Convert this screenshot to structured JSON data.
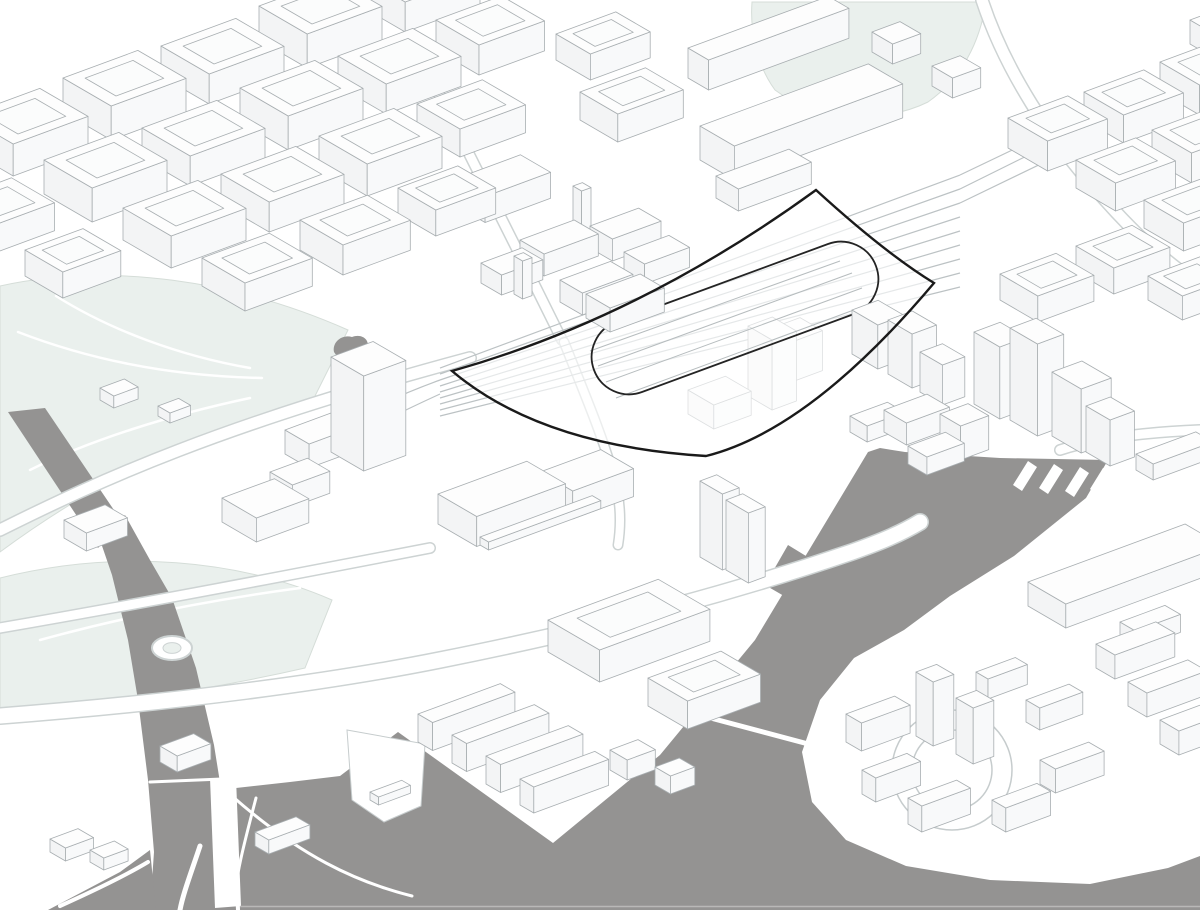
{
  "palette": {
    "bg": "#ffffff",
    "water": "#949392",
    "park": "#eaf0ed",
    "park_stroke": "#d5ddd8",
    "line": "#a8aeb1",
    "line_soft": "#c6cccd",
    "road_stroke": "#cdd3d3",
    "rail": "#bcc2c4",
    "rail_faint": "#b6bcbe",
    "face_top": "#fdfdfd",
    "face_left": "#f3f4f5",
    "face_right": "#f8f9fa",
    "court_fill": "#fbfcfc",
    "site_stroke": "#1a1a1a",
    "site_loop_stroke": "#242424",
    "site_fill": "#ffffff",
    "site_fill_opacity": 0.62,
    "waterline": "#b9b8b7"
  },
  "scene": {
    "width": 1200,
    "height": 910,
    "iso": {
      "u": [
        0.935,
        -0.345
      ],
      "v": [
        0.86,
        0.5
      ]
    },
    "parks": [
      "M0,286 C110,262 235,280 348,330 L312,402 C210,426 100,478 0,552 Z",
      "M0,578 C120,548 240,560 332,600 L305,668 C200,692 95,706 0,716 Z",
      "M752,2 L986,2 C980,42 962,78 928,102 C880,126 812,118 775,90 C756,64 750,30 752,2 Z"
    ],
    "park_paths": [
      "M18,332 C80,356 160,376 262,378",
      "M56,296 C110,330 180,356 250,368",
      "M30,470 C90,440 170,415 250,398",
      "M40,640 C120,618 210,600 300,588"
    ],
    "pond": "M334,352 C332,342 342,334 352,337 C362,333 371,340 367,350 C362,362 340,363 334,352 Z",
    "water": [
      "M8,412 L45,408 L122,522 L98,548 Z",
      "M100,540 L125,515 L150,560 L172,598 L196,668 L214,745 L226,820 L234,870 L236,910 L150,910 L154,852 L148,780 L138,700 L128,640 L112,575 Z",
      "M48,910 L120,872 L150,850 L156,910 Z",
      "M553,843 L660,755 L755,640 L868,452 L880,448 L905,452 L1000,458 L1108,460 L1086,498 L1014,556 L950,596 L904,630 L854,658 L820,700 L802,752 L812,802 L846,840 L906,866 L990,880 L1090,884 L1168,868 L1200,856 L1200,910 L240,910 L236,788 L290,782 L340,776 L398,732 Z",
      "M765,585 L788,545 L806,556 L784,596 Z",
      "M792,600 L820,552 L842,564 L816,612 Z"
    ],
    "quay_strokes": [
      [
        "M232,796 C300,856 356,882 412,896",
        3
      ],
      [
        "M256,798 C244,844 236,874 234,904",
        3
      ],
      [
        "M150,782 L222,779",
        3
      ],
      [
        "M200,846 C190,876 183,894 180,910",
        5
      ],
      [
        "M60,906 C100,888 128,874 148,862",
        4
      ],
      [
        "M688,712 L812,745",
        5
      ]
    ],
    "white_polys": [
      "M210,778 L236,778 L241,906 L215,908 Z",
      "M347,730 L425,744 L421,806 L384,822 L352,800 Z",
      "M1028,461 l-15,24 l9,6 l15,-24 Z",
      "M1054,464 l-15,24 l9,6 l15,-24 Z",
      "M1080,467 l-15,24 l9,6 l15,-24 Z",
      "M1103,468 l-13,21 l8,6 l14,-22 Z"
    ],
    "waterline": [
      240,
      906.5,
      1200,
      906.5
    ],
    "roads": [
      [
        "M0,716 C180,702 330,682 440,660 C620,624 740,590 852,552 C880,542 900,534 920,522",
        15,
        1
      ],
      [
        "M0,530 C100,480 220,425 470,358",
        11,
        1
      ],
      [
        "M436,88 C475,165 520,255 562,340",
        9,
        1
      ],
      [
        "M982,0 C1005,70 1050,140 1105,200 C1145,245 1175,268 1200,285",
        11,
        1
      ],
      [
        "M0,628 C150,602 290,575 430,548",
        9,
        1
      ],
      [
        "M564,342 C585,395 600,430 612,470 C620,495 622,520 618,545",
        8,
        1
      ],
      [
        "M1060,450 C1100,437 1150,432 1200,430",
        9,
        1
      ]
    ],
    "roundabout": {
      "cx": 172,
      "cy": 648,
      "rx": 20,
      "ry": 12
    },
    "ground_circles": [
      {
        "cx": 952,
        "cy": 770,
        "r": 60
      },
      {
        "cx": 952,
        "cy": 770,
        "r": 40
      }
    ],
    "rail_main": [
      [
        440,
        368,
        960,
        175
      ],
      [
        440,
        374,
        960,
        189
      ],
      [
        440,
        380,
        960,
        203
      ],
      [
        440,
        386,
        960,
        217
      ],
      [
        440,
        392,
        960,
        231
      ],
      [
        440,
        398,
        960,
        245
      ],
      [
        440,
        404,
        960,
        259
      ],
      [
        440,
        410,
        960,
        273
      ],
      [
        440,
        416,
        960,
        287
      ],
      [
        960,
        175,
        1075,
        120
      ],
      [
        960,
        189,
        1075,
        132
      ],
      [
        960,
        203,
        1078,
        146
      ]
    ],
    "rail_sidings": [
      "M440,380 C380,402 330,428 298,450",
      "M440,394 C392,416 348,438 318,458"
    ],
    "inner_tracks": [
      [
        598,
        366,
        852,
        273
      ],
      [
        606,
        382,
        862,
        288
      ],
      [
        616,
        398,
        870,
        304
      ],
      [
        590,
        351,
        840,
        261
      ]
    ],
    "site": {
      "outer": "M452,371 Q640,318 816,190 Q885,253 934,283 Q810,430 706,456 Q541,446 452,371 Z",
      "loop": "M642,392 L854,314 A37,37 0 0 0 828,244 L616,322 A37,37 0 0 0 642,392 Z"
    },
    "buildings_faded": [
      [
        688,
        414,
        40,
        30,
        24
      ],
      [
        748,
        396,
        26,
        28,
        70
      ],
      [
        772,
        368,
        30,
        26,
        40
      ]
    ],
    "buildings": [
      [
        -35,
        148,
        80,
        56,
        32,
        "c"
      ],
      [
        63,
        112,
        80,
        56,
        34,
        "c"
      ],
      [
        161,
        76,
        80,
        56,
        30,
        "c"
      ],
      [
        259,
        40,
        80,
        56,
        34,
        "c"
      ],
      [
        357,
        4,
        80,
        56,
        30,
        "c"
      ],
      [
        -54,
        230,
        70,
        50,
        28,
        "c"
      ],
      [
        44,
        194,
        80,
        56,
        34,
        "c"
      ],
      [
        142,
        158,
        80,
        56,
        30,
        "c"
      ],
      [
        240,
        122,
        80,
        56,
        34,
        "c"
      ],
      [
        338,
        86,
        80,
        56,
        30,
        "c"
      ],
      [
        436,
        50,
        70,
        50,
        30,
        "c"
      ],
      [
        25,
        276,
        62,
        44,
        26,
        "c"
      ],
      [
        123,
        240,
        80,
        56,
        32,
        "c"
      ],
      [
        221,
        204,
        80,
        56,
        30,
        "c"
      ],
      [
        319,
        168,
        80,
        56,
        32,
        "c"
      ],
      [
        417,
        132,
        70,
        50,
        28,
        "c"
      ],
      [
        202,
        286,
        72,
        50,
        28,
        "c"
      ],
      [
        300,
        250,
        72,
        50,
        30,
        "c"
      ],
      [
        398,
        214,
        64,
        44,
        26,
        "c"
      ],
      [
        455,
        205,
        70,
        35,
        26
      ],
      [
        520,
        262,
        58,
        28,
        22
      ],
      [
        481,
        283,
        44,
        24,
        20
      ],
      [
        560,
        302,
        54,
        26,
        22
      ],
      [
        586,
        318,
        58,
        28,
        24
      ],
      [
        573,
        228,
        10,
        10,
        42
      ],
      [
        514,
        294,
        10,
        10,
        38
      ],
      [
        590,
        248,
        52,
        26,
        22
      ],
      [
        624,
        272,
        48,
        24,
        20
      ],
      [
        688,
        78,
        150,
        24,
        30
      ],
      [
        700,
        160,
        180,
        40,
        34
      ],
      [
        716,
        198,
        78,
        26,
        22
      ],
      [
        872,
        52,
        30,
        24,
        20
      ],
      [
        932,
        86,
        30,
        24,
        20
      ],
      [
        580,
        120,
        70,
        44,
        28,
        "c"
      ],
      [
        556,
        60,
        64,
        40,
        26,
        "c"
      ],
      [
        1008,
        148,
        64,
        46,
        30,
        "c"
      ],
      [
        1084,
        120,
        64,
        46,
        28,
        "c"
      ],
      [
        1160,
        92,
        64,
        46,
        30,
        "c"
      ],
      [
        1076,
        188,
        64,
        46,
        28,
        "c"
      ],
      [
        1152,
        160,
        64,
        46,
        30,
        "c"
      ],
      [
        1144,
        228,
        64,
        46,
        28,
        "c"
      ],
      [
        1190,
        44,
        56,
        40,
        24,
        "c"
      ],
      [
        1000,
        300,
        60,
        44,
        26,
        "c"
      ],
      [
        1076,
        272,
        60,
        44,
        26,
        "c"
      ],
      [
        1148,
        300,
        56,
        40,
        24,
        "c"
      ],
      [
        884,
        432,
        46,
        26,
        22
      ],
      [
        908,
        464,
        40,
        22,
        18
      ],
      [
        940,
        448,
        30,
        24,
        34
      ],
      [
        974,
        404,
        28,
        30,
        72
      ],
      [
        1010,
        420,
        28,
        32,
        92
      ],
      [
        1052,
        436,
        32,
        34,
        64
      ],
      [
        1086,
        452,
        26,
        28,
        46
      ],
      [
        1028,
        606,
        168,
        44,
        24
      ],
      [
        1136,
        470,
        64,
        20,
        16
      ],
      [
        1120,
        640,
        48,
        18,
        18
      ],
      [
        1096,
        668,
        64,
        22,
        24
      ],
      [
        1128,
        706,
        64,
        22,
        24
      ],
      [
        1160,
        744,
        64,
        22,
        24
      ],
      [
        846,
        742,
        52,
        18,
        28
      ],
      [
        862,
        794,
        48,
        16,
        24
      ],
      [
        908,
        824,
        52,
        16,
        26
      ],
      [
        992,
        824,
        48,
        16,
        24
      ],
      [
        1040,
        784,
        52,
        18,
        24
      ],
      [
        1026,
        722,
        46,
        16,
        22
      ],
      [
        976,
        692,
        42,
        14,
        20
      ],
      [
        916,
        736,
        22,
        20,
        64
      ],
      [
        956,
        754,
        22,
        20,
        56
      ],
      [
        331,
        452,
        45,
        38,
        95
      ],
      [
        222,
        522,
        56,
        40,
        24
      ],
      [
        270,
        494,
        40,
        26,
        22
      ],
      [
        285,
        454,
        55,
        28,
        24
      ],
      [
        438,
        524,
        95,
        45,
        30
      ],
      [
        540,
        500,
        65,
        38,
        28
      ],
      [
        480,
        545,
        120,
        10,
        8
      ],
      [
        700,
        557,
        18,
        26,
        76
      ],
      [
        726,
        570,
        18,
        26,
        70
      ],
      [
        852,
        354,
        28,
        30,
        44
      ],
      [
        888,
        374,
        26,
        28,
        54
      ],
      [
        920,
        392,
        24,
        26,
        40
      ],
      [
        850,
        432,
        40,
        20,
        16
      ],
      [
        64,
        538,
        44,
        26,
        18
      ],
      [
        548,
        652,
        118,
        60,
        32,
        "c"
      ],
      [
        648,
        706,
        78,
        46,
        28,
        "c"
      ],
      [
        418,
        742,
        88,
        17,
        28
      ],
      [
        452,
        763,
        88,
        17,
        28
      ],
      [
        486,
        784,
        88,
        17,
        28
      ],
      [
        520,
        805,
        80,
        16,
        26
      ],
      [
        610,
        770,
        30,
        20,
        20
      ],
      [
        655,
        785,
        26,
        18,
        18
      ],
      [
        160,
        762,
        36,
        20,
        16
      ],
      [
        50,
        852,
        30,
        18,
        13
      ],
      [
        90,
        862,
        26,
        16,
        12
      ],
      [
        255,
        846,
        44,
        16,
        14
      ],
      [
        370,
        800,
        34,
        10,
        8
      ],
      [
        100,
        400,
        26,
        16,
        12
      ],
      [
        158,
        416,
        22,
        14,
        10
      ]
    ]
  }
}
